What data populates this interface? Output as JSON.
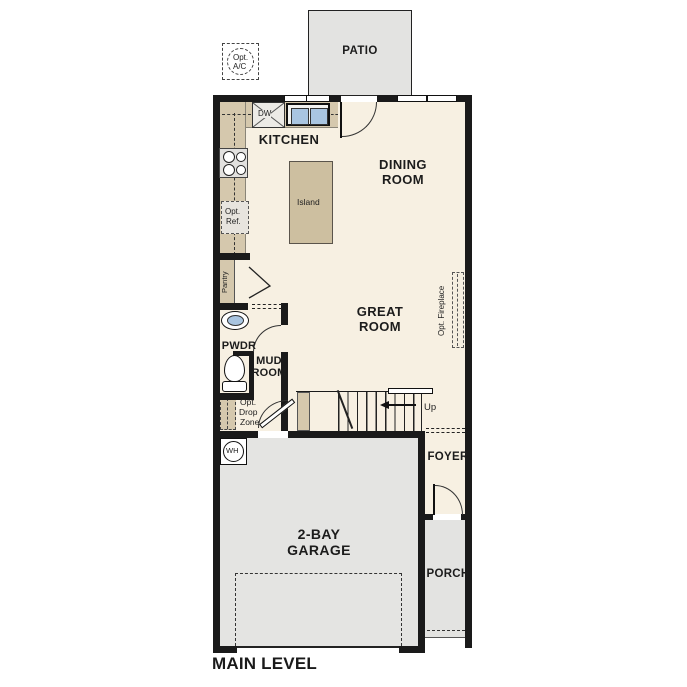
{
  "title": "MAIN LEVEL",
  "rooms": {
    "patio": "PATIO",
    "kitchen": "KITCHEN",
    "dining": [
      "DINING",
      "ROOM"
    ],
    "great": [
      "GREAT",
      "ROOM"
    ],
    "pwdr": "PWDR",
    "mud": [
      "MUD",
      "ROOM"
    ],
    "foyer": "FOYER",
    "garage": [
      "2-BAY",
      "GARAGE"
    ],
    "porch": "PORCH"
  },
  "fixtures": {
    "opt_ac": [
      "Opt.",
      "A/C"
    ],
    "dw": "DW",
    "island": "Island",
    "opt_ref": [
      "Opt.",
      "Ref."
    ],
    "pantry": "Pantry",
    "opt_fireplace": "Opt. Fireplace",
    "opt_drop_zone": [
      "Opt.",
      "Drop",
      "Zone"
    ],
    "up": "Up",
    "wh": "WH"
  },
  "colors": {
    "wall": "#1a1a1a",
    "floor": "#f7f0e2",
    "counter": "#d5c8ad",
    "island": "#cdbfa0",
    "concrete": "#e3e3e1",
    "sink_blue": "#a9c5e1"
  }
}
